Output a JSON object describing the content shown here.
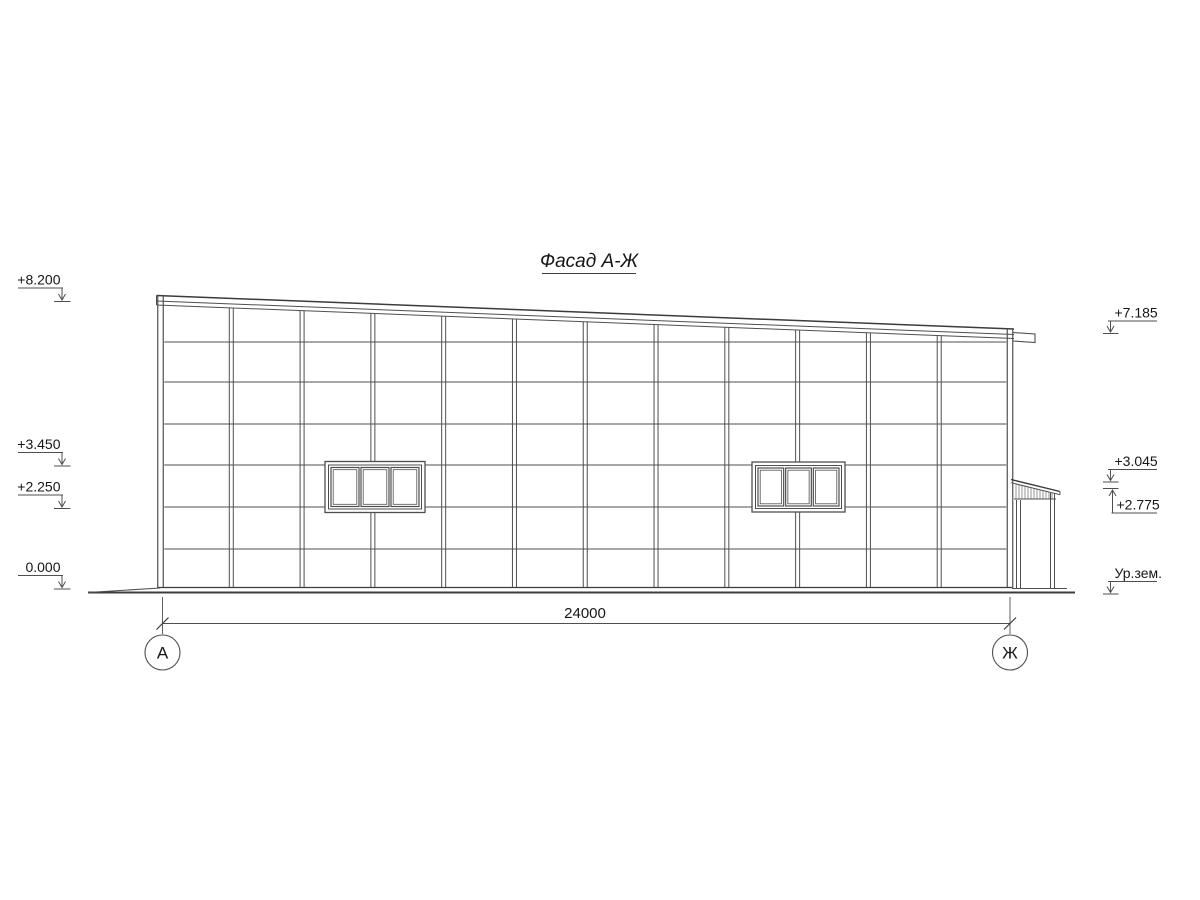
{
  "title": "Фасад А-Ж",
  "dimension": {
    "label": "24000"
  },
  "axes": {
    "left": "А",
    "right": "Ж"
  },
  "ground_label": "Ур.зем.",
  "colors": {
    "line": "#4f4f4f",
    "heavy": "#3c3c3c",
    "text": "#161616"
  },
  "elevation_marks": {
    "left": [
      {
        "label": "+8.200",
        "tip": 300
      },
      {
        "label": "+3.450",
        "tip": 464.5
      },
      {
        "label": "+2.250",
        "tip": 507
      },
      {
        "label": "0.000",
        "tip": 587.5
      }
    ],
    "right": [
      {
        "label": "+7.185",
        "tip": 332,
        "dir": "down"
      },
      {
        "label": "+3.045",
        "tip": 480.5,
        "dir": "down"
      },
      {
        "label": "+2.775",
        "tip": 488.5,
        "dir": "up"
      },
      {
        "label": "Ур.зем.",
        "tip": 592.5,
        "dir": "down"
      }
    ]
  },
  "drawing": {
    "building": {
      "leftCx": 160.5,
      "rightCx": 1010,
      "bottom": 587.5,
      "edgeHalf": 2.75,
      "mullHalf": 2,
      "bays": 12,
      "rows": [
        342,
        382,
        424,
        465,
        507,
        549
      ],
      "roof": {
        "x1": 156.5,
        "y1": 295.5,
        "x2": 1014,
        "y2": 329,
        "offsets": [
          0,
          5.5,
          9.5
        ]
      }
    },
    "windows": [
      {
        "x": 325,
        "y": 461.5,
        "w": 100,
        "h": 51
      },
      {
        "x": 752,
        "y": 462,
        "w": 93,
        "h": 50
      }
    ],
    "annex": {
      "roof": {
        "x1": 1011,
        "y1": 479.5,
        "x2": 1060,
        "y2": 491.5,
        "gap": 3.2
      },
      "fascia": {
        "x1": 1014,
        "x2": 1056,
        "y": 499
      },
      "hatch": {
        "x1": 1016,
        "x2": 1054,
        "step": 3,
        "yBottom": 498.5
      },
      "wallL": {
        "xa": 1016.5,
        "xb": 1020.5,
        "top": 500,
        "bottom": 588
      },
      "wallR": {
        "xa": 1050.5,
        "xb": 1054.5,
        "top": 493,
        "bottom": 588
      },
      "base": {
        "x1": 1012,
        "x2": 1067,
        "y": 588.5
      }
    },
    "gutter": {
      "x1": 1013,
      "x2": 1035,
      "yTop1": 332.5,
      "yTop2": 334,
      "yBot1": 341,
      "yBot2": 342.5
    },
    "ground": {
      "x1": 88,
      "x2": 1075,
      "y": 592.5,
      "riseX": 160,
      "riseY": 588
    },
    "dim": {
      "y": 623.5,
      "x1": 162.5,
      "x2": 1010,
      "extTop": 597,
      "extBottom": 634,
      "labelX": 585,
      "labelY": 618
    },
    "axis_circles": {
      "r": 17.5,
      "leftCx": 162.5,
      "rightCx": 1010,
      "cy": 652.5
    },
    "marks_left_geo": {
      "ux1": 18,
      "ux2": 63,
      "vx": 62,
      "drop": 12,
      "lvlX1": 54,
      "lvlX2": 70.5,
      "textX": 60.5
    },
    "marks_right_geo": {
      "ux1": 1108,
      "ux2": 1157,
      "vx": 1110.5,
      "drop": 11,
      "lvlX1": 1103,
      "lvlX2": 1118.5,
      "textX": 1112.5
    }
  }
}
